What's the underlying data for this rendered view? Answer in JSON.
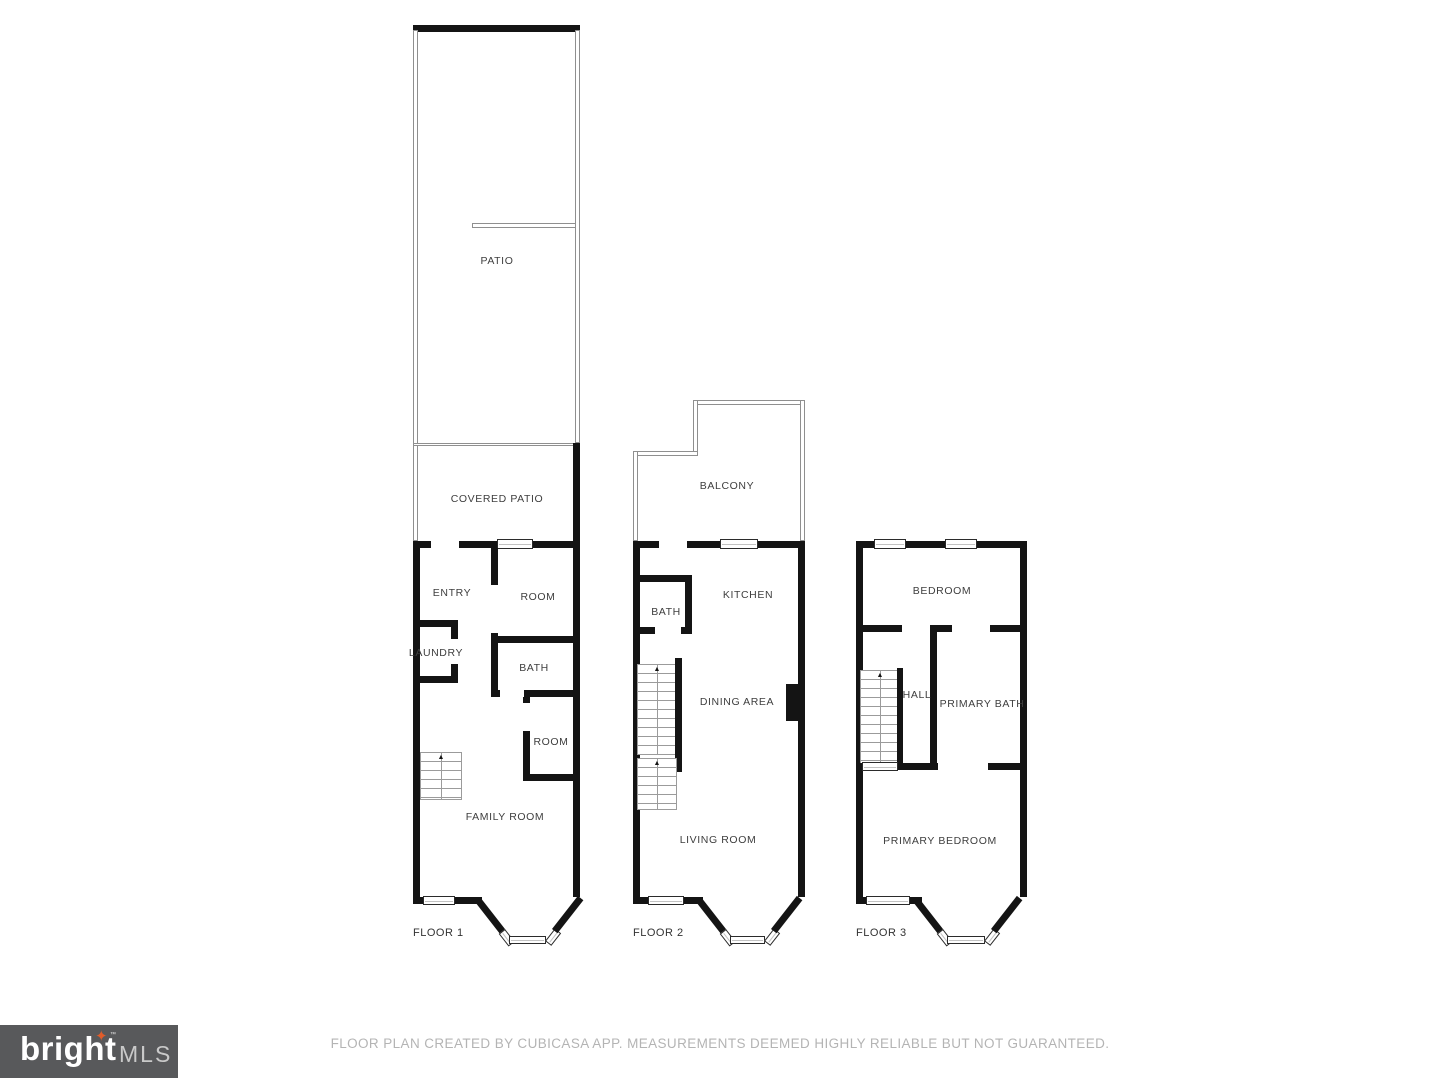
{
  "floor1": {
    "label": "FLOOR 1",
    "patio": "PATIO",
    "covered_patio": "COVERED PATIO",
    "entry": "ENTRY",
    "room_a": "ROOM",
    "laundry": "LAUNDRY",
    "bath": "BATH",
    "room_b": "ROOM",
    "family_room": "FAMILY ROOM"
  },
  "floor2": {
    "label": "FLOOR 2",
    "balcony": "BALCONY",
    "kitchen": "KITCHEN",
    "bath": "BATH",
    "dining_area": "DINING AREA",
    "living_room": "LIVING ROOM"
  },
  "floor3": {
    "label": "FLOOR 3",
    "bedroom": "BEDROOM",
    "hall": "HALL",
    "primary_bath": "PRIMARY BATH",
    "primary_bedroom": "PRIMARY BEDROOM"
  },
  "footer": {
    "disclaimer": "FLOOR PLAN CREATED BY CUBICASA APP. MEASUREMENTS DEEMED HIGHLY RELIABLE BUT NOT GUARANTEED."
  },
  "logo": {
    "brand": "bright",
    "suffix": "MLS",
    "tm": "™",
    "star_glyph": "✦"
  },
  "colors": {
    "wall": "#141414",
    "label_text": "#3e3e3e",
    "footer_text": "#b4b4b4",
    "logo_background": "#58595b",
    "logo_star": "#e05c2a"
  }
}
